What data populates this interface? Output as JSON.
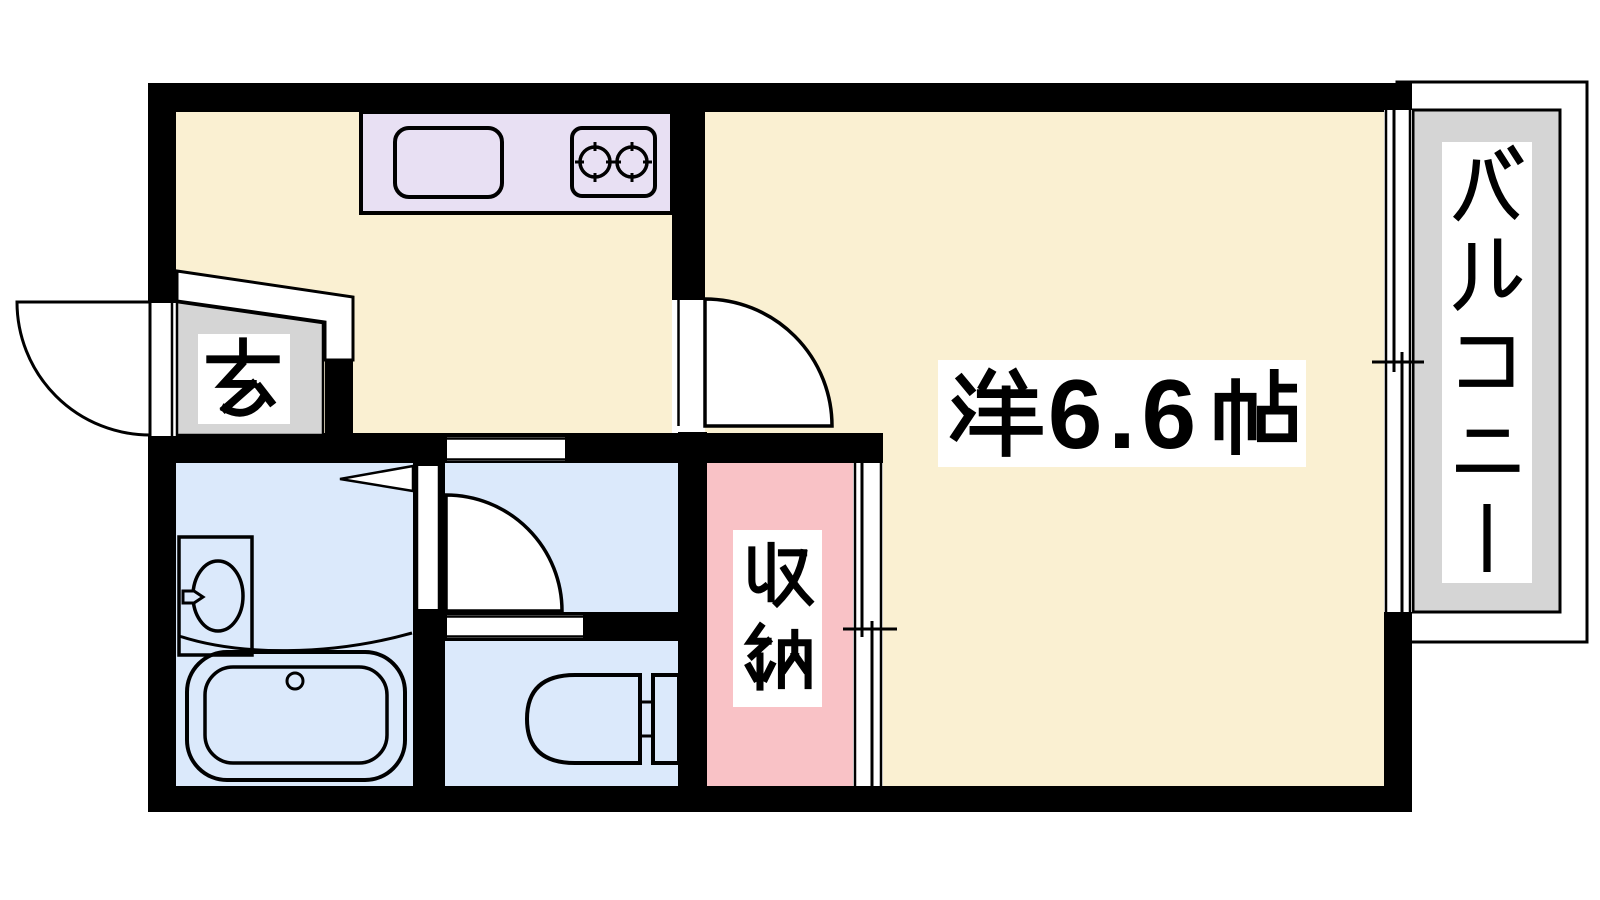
{
  "floorplan": {
    "labels": {
      "genkan": "玄",
      "storage": "収納",
      "main_room": "洋6.6帖",
      "main_room_size": "6.6",
      "balcony": "バルコニー"
    },
    "colors": {
      "wall": "#000000",
      "room_floor": "#FAF0D2",
      "wet_area_floor": "#DBE9FB",
      "storage_floor": "#F9C2C6",
      "entrance_floor": "#D5D5D5",
      "balcony_floor": "#D5D5D5",
      "kitchen_counter": "#E8E0F3",
      "background": "#FFFFFF",
      "line": "#000000"
    },
    "fixtures": [
      "kitchen-sink",
      "gas-stove-two-burner",
      "washbasin",
      "bathtub",
      "toilet",
      "entrance-door-swing",
      "kitchen-door-swing",
      "washroom-door-swing",
      "storage-sliding-door",
      "balcony-sliding-window"
    ]
  }
}
